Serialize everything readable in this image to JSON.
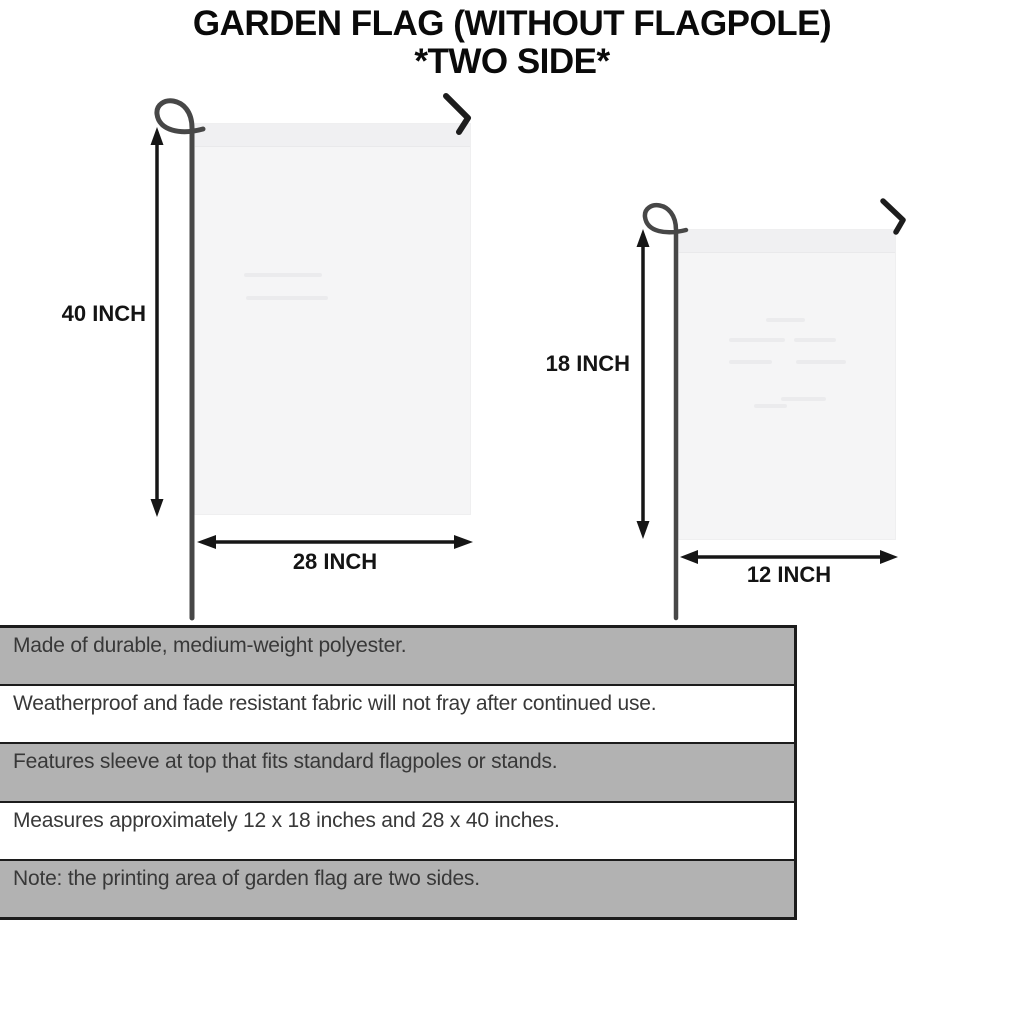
{
  "title": {
    "line1": "GARDEN FLAG (WITHOUT FLAGPOLE)",
    "line2": "*TWO SIDE*"
  },
  "diagram": {
    "large_flag": {
      "height_label": "40 INCH",
      "width_label": "28 INCH"
    },
    "small_flag": {
      "height_label": "18 INCH",
      "width_label": "12 INCH"
    }
  },
  "specs": {
    "rows": [
      {
        "text": "Made of durable, medium-weight polyester.",
        "shaded": true
      },
      {
        "text": "Weatherproof and fade resistant fabric will not fray after continued use.",
        "shaded": false
      },
      {
        "text": "Features sleeve at top that fits standard flagpoles or stands.",
        "shaded": true
      },
      {
        "text": "Measures approximately 12 x 18 inches and 28 x 40 inches.",
        "shaded": false
      },
      {
        "text": "Note: the printing area of garden flag are two sides.",
        "shaded": true
      }
    ]
  },
  "colors": {
    "title_black": "#0a0a0a",
    "border_black": "#1c1c1c",
    "bar_gray": "#b2b2b2",
    "text_dark": "#383838",
    "flag_fill": "#f5f5f6",
    "pole_gray": "#474747",
    "hook_black": "#1d1d1d",
    "arrow_black": "#161616"
  }
}
